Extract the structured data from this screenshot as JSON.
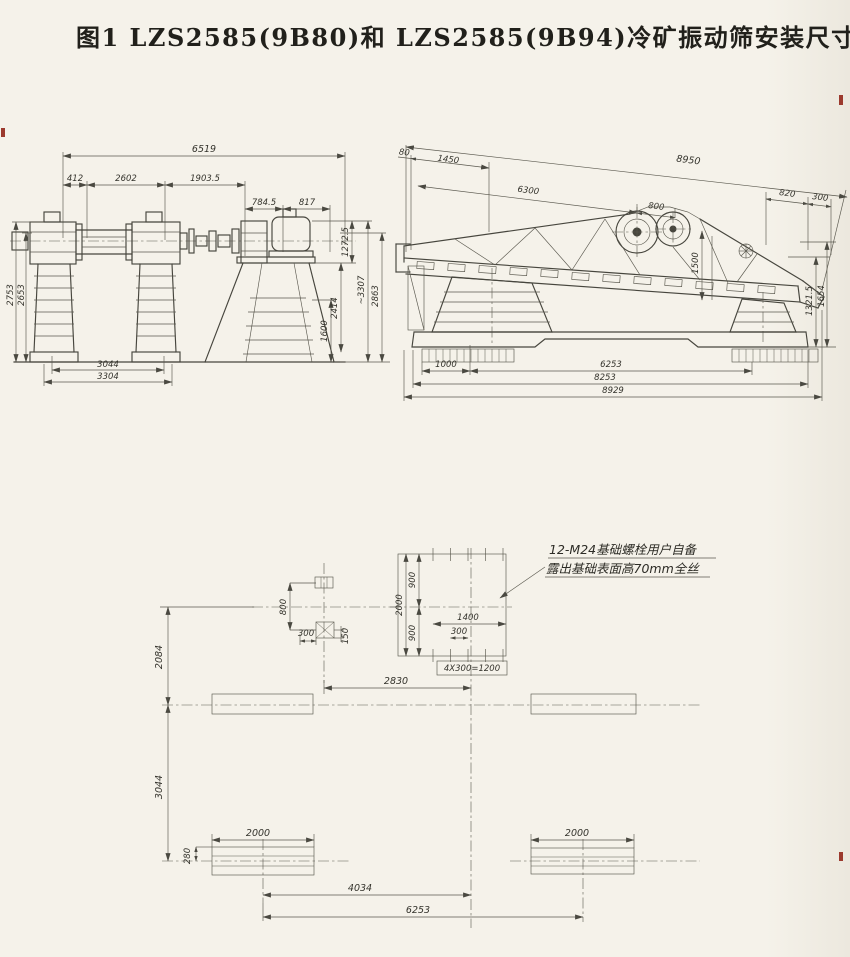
{
  "title": "图1  LZS2585(9B80)和 LZS2585(9B94)冷矿振动筛安装尺寸",
  "left_view": {
    "top_dims": [
      "6519",
      "412",
      "2602",
      "1903.5",
      "784.5",
      "817"
    ],
    "left_dims": [
      "2753",
      "2653"
    ],
    "right_dims": [
      "1272.5",
      "2414",
      "1600",
      "~3307",
      "2863"
    ],
    "bottom_dims": [
      "3044",
      "3304"
    ]
  },
  "right_view": {
    "top_dims": [
      "80",
      "1450",
      "8950",
      "6300",
      "800",
      "820",
      "300"
    ],
    "side_dims": [
      "1321.5",
      "1654"
    ],
    "inner_dims": [
      "1500"
    ],
    "bottom_dims": [
      "1000",
      "6253",
      "8253",
      "8929"
    ]
  },
  "plan_view": {
    "left_dims": [
      "2084",
      "3044",
      "280"
    ],
    "small_pad_dims": [
      "800",
      "300",
      "150"
    ],
    "bolt_pad_dims": [
      "2000",
      "900",
      "900",
      "1400",
      "300",
      "4X300=1200"
    ],
    "center_dims": [
      "2830"
    ],
    "bottom_dims": [
      "2000",
      "2000",
      "4034",
      "6253"
    ],
    "note_lines": [
      "12-M24基础螺栓用户自备",
      "露出基础表面高70mm全丝"
    ]
  }
}
